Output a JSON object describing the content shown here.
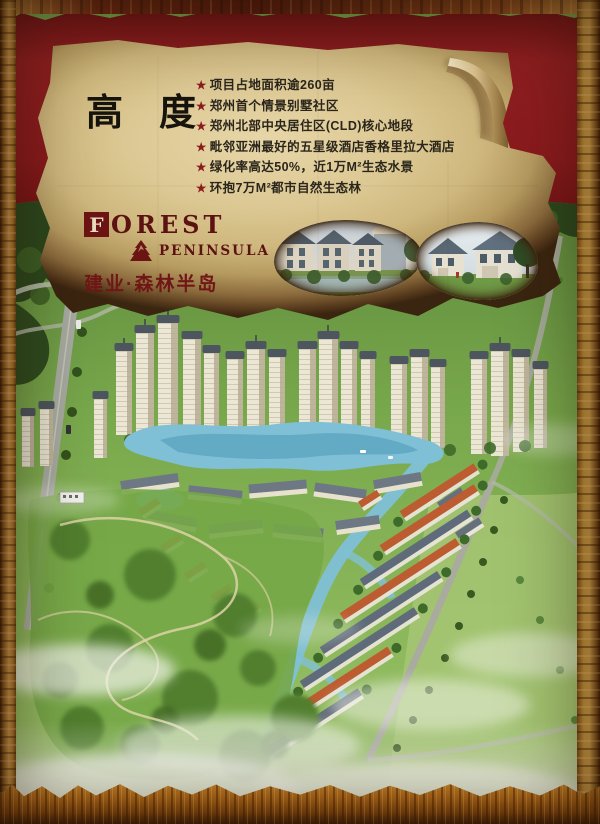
{
  "poster": {
    "title": "高度",
    "bullet_marker": "★",
    "bullets": [
      "项目占地面积逾260亩",
      "郑州首个情景别墅社区",
      "郑州北部中央居住区(CLD)核心地段",
      "毗邻亚洲最好的五星级酒店香格里拉大酒店",
      "绿化率高达50%，近1万M²生态水景",
      "环抱7万M²都市自然生态林"
    ],
    "logo": {
      "drop_cap": "F",
      "name_rest": "OREST",
      "subname": "PENINSULA",
      "chinese_name": "建业·森林半岛"
    },
    "colors": {
      "band_maroon": "#8b1b1d",
      "parchment": "#d7c38d",
      "frame_gold": "#c8913f",
      "logo_maroon": "#6d1414",
      "text_dark": "#2b261c"
    }
  }
}
